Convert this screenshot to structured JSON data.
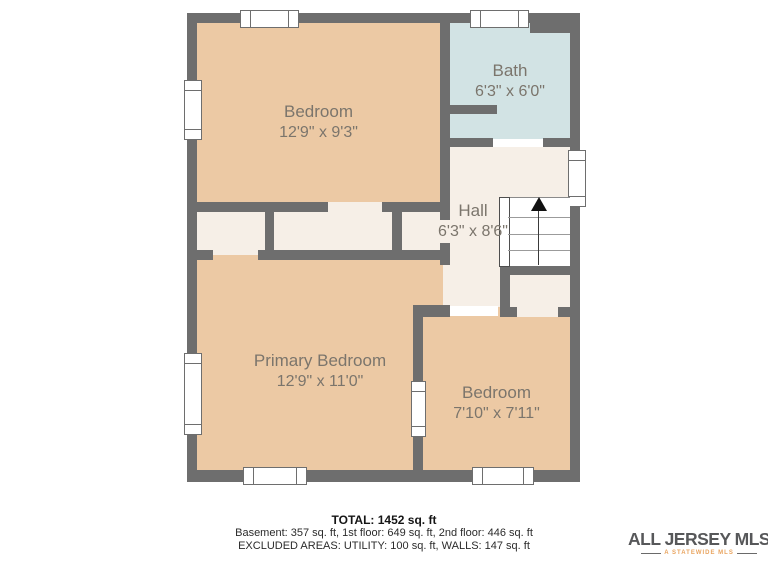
{
  "plan": {
    "rooms": {
      "bedroom_top": {
        "name": "Bedroom",
        "dims": "12'9\" x 9'3\""
      },
      "bath": {
        "name": "Bath",
        "dims": "6'3\" x 6'0\""
      },
      "hall": {
        "name": "Hall",
        "dims": "6'3\" x 8'6\""
      },
      "primary_bedroom": {
        "name": "Primary Bedroom",
        "dims": "12'9\" x 11'0\""
      },
      "bedroom_right": {
        "name": "Bedroom",
        "dims": "7'10\" x 7'11\""
      }
    },
    "colors": {
      "wall": "#6e6e6e",
      "room_tan": "#ecc9a4",
      "bath_blue": "#d2e3e4",
      "hall_cream": "#f6efe7",
      "label_text": "#7b756c"
    }
  },
  "footer": {
    "total": "TOTAL: 1452 sq. ft",
    "breakdown": "Basement: 357 sq. ft, 1st floor: 649 sq. ft, 2nd floor: 446 sq. ft",
    "excluded": "EXCLUDED AREAS: UTILITY: 100 sq. ft, WALLS: 147 sq. ft"
  },
  "logo": {
    "name": "ALL JERSEY MLS",
    "tagline": "A STATEWIDE MLS",
    "colors": {
      "orange": "#e9a45f",
      "blue_gray": "#7ba0ac",
      "text": "#57585a"
    }
  }
}
